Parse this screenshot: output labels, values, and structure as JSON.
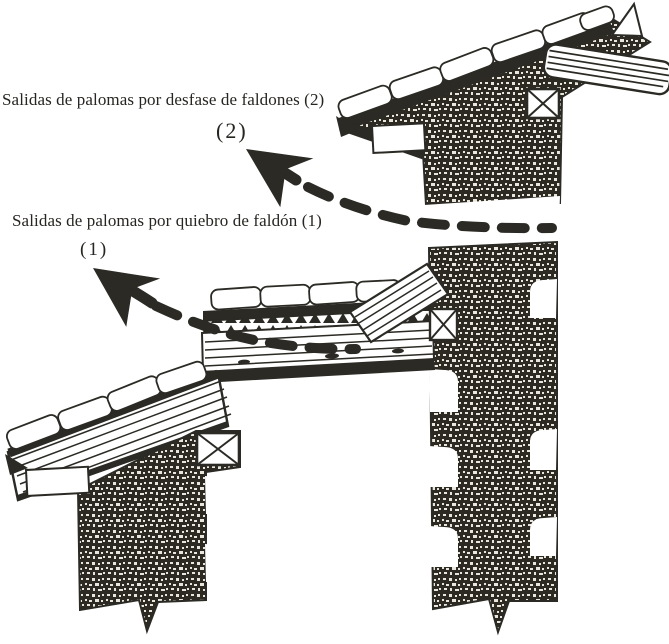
{
  "figure": {
    "type": "architectural-section-diagram",
    "labels": {
      "desfase": "Salidas de palomas por desfase de faldones (2)",
      "desfase_marker": "(2)",
      "quiebro": "Salidas de palomas por quiebro de faldón (1)",
      "quiebro_marker": "(1)"
    },
    "colors": {
      "ink": "#2b2a24",
      "paper": "#ffffff"
    }
  }
}
